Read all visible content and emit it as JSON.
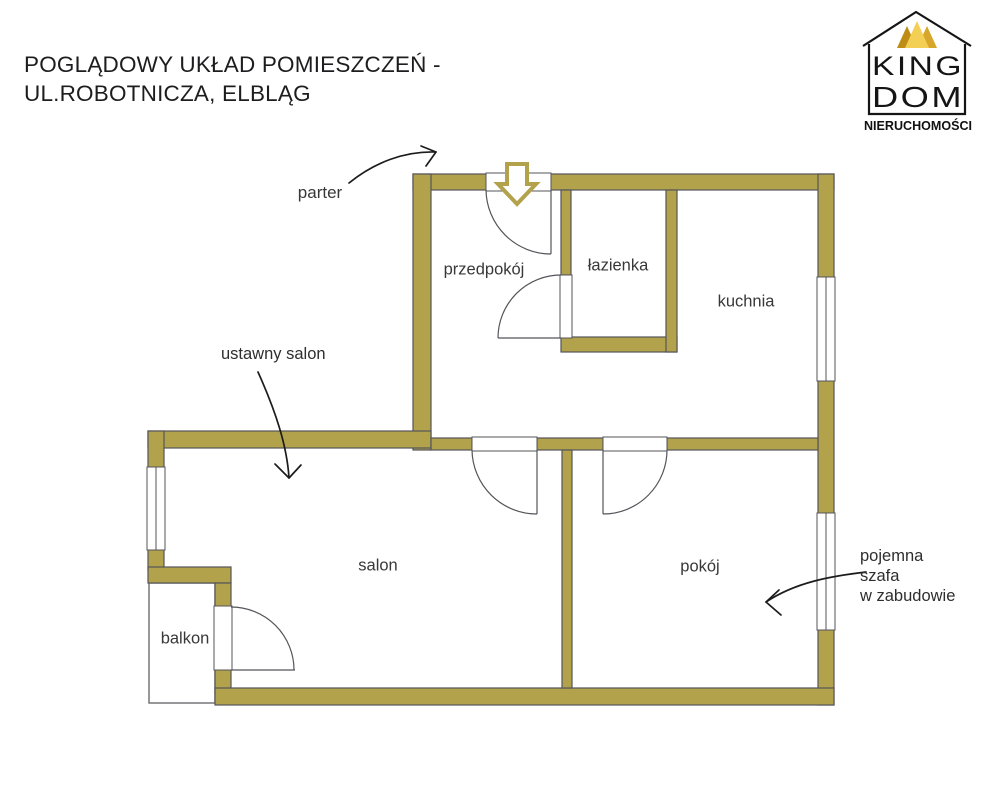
{
  "title": {
    "text": "POGLĄDOWY UKŁAD POMIESZCZEŃ -\nUL.ROBOTNICZA, ELBLĄG"
  },
  "logo": {
    "word_top": "KING",
    "word_bottom": "DOM",
    "subtitle": "NIERUCHOMOŚCI"
  },
  "rooms": {
    "hall": "przedpokój",
    "bathroom": "łazienka",
    "kitchen": "kuchnia",
    "living": "salon",
    "room": "pokój",
    "balcony": "balkon"
  },
  "annotations": {
    "floor": "parter",
    "living_note": "ustawny salon",
    "wardrobe_note": "pojemna\nszafa\nw zabudowie"
  },
  "colors": {
    "wall_fill": "#b2a24c",
    "wall_outline": "#54555a",
    "annotation_ink": "#1c1c1c",
    "label_ink": "#383838",
    "crown_dark": "#bd8d15",
    "crown_mid": "#d7a62a",
    "crown_light": "#f3cf56",
    "logo_ink": "#151515"
  }
}
